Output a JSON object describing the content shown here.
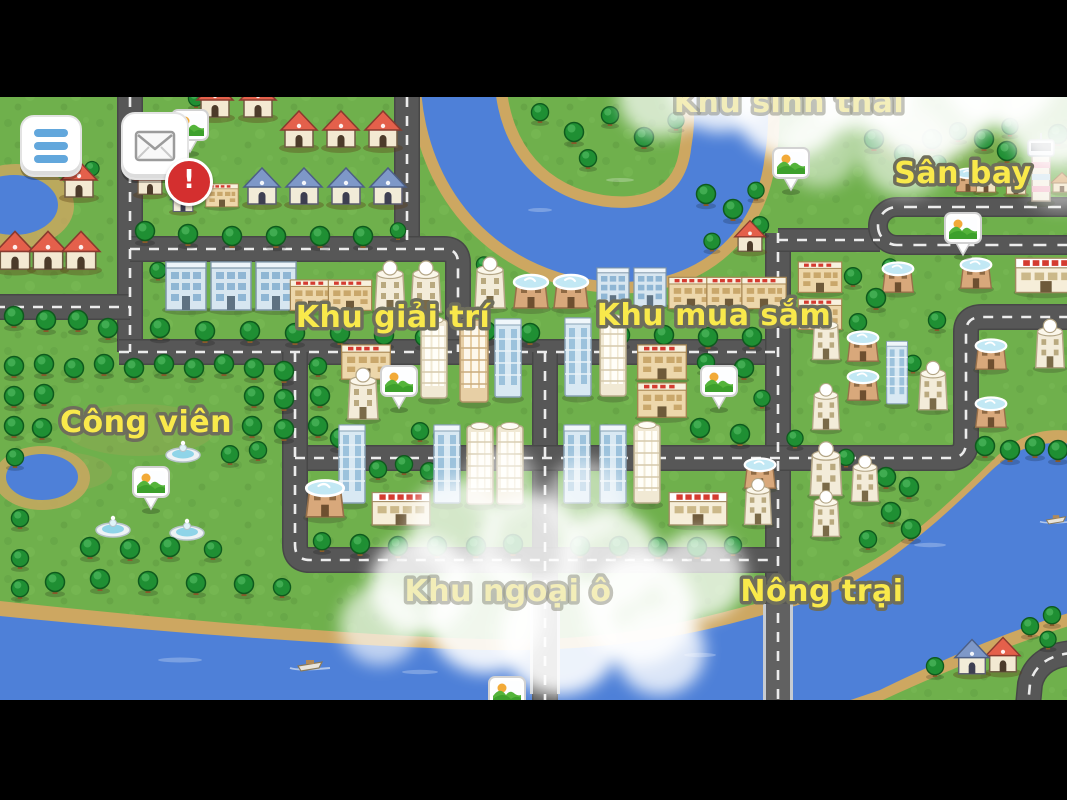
{
  "window": {
    "width": 1067,
    "height": 800,
    "letterbox_color": "#000000"
  },
  "hud": {
    "menu_button": {
      "icon": "hamburger-icon"
    },
    "mail_button": {
      "icon": "envelope-icon",
      "notification": "!"
    }
  },
  "map": {
    "region_labels": [
      {
        "id": "khu-sinh-thai",
        "text": "Khu sinh thái",
        "x": 789,
        "y": 112,
        "cloud_faded": true
      },
      {
        "id": "san-bay",
        "text": "Sân bay",
        "x": 963,
        "y": 183,
        "cloud_faded": false
      },
      {
        "id": "khu-giai-tri",
        "text": "Khu giải trí",
        "x": 393,
        "y": 327,
        "cloud_faded": false
      },
      {
        "id": "khu-mua-sam",
        "text": "Khu mua sắm",
        "x": 714,
        "y": 325,
        "cloud_faded": false
      },
      {
        "id": "cong-vien",
        "text": "Công viên",
        "x": 146,
        "y": 432,
        "cloud_faded": false
      },
      {
        "id": "khu-ngoai-o",
        "text": "Khu ngoại ô",
        "x": 508,
        "y": 601,
        "cloud_faded": true
      },
      {
        "id": "nong-trai",
        "text": "Nông trại",
        "x": 822,
        "y": 601,
        "cloud_faded": false
      }
    ],
    "pins": [
      {
        "id": "pin-residential",
        "x": 190,
        "y": 125
      },
      {
        "id": "pin-eco-area",
        "x": 791,
        "y": 163
      },
      {
        "id": "pin-airport",
        "x": 963,
        "y": 228
      },
      {
        "id": "pin-downtown-west",
        "x": 399,
        "y": 381
      },
      {
        "id": "pin-downtown-east",
        "x": 719,
        "y": 381
      },
      {
        "id": "pin-park",
        "x": 151,
        "y": 482
      },
      {
        "id": "pin-bridge",
        "x": 507,
        "y": 692
      }
    ],
    "colors": {
      "grass": "#6fb04c",
      "river": "#4e80d8",
      "sand": "#cda761",
      "road": "#575757",
      "road_dash": "#ececec",
      "label_fill": "#f9e94b",
      "label_stroke": "#6e6e5c",
      "badge": "#d42f2f",
      "menu_bars": "#62a7dc"
    }
  }
}
